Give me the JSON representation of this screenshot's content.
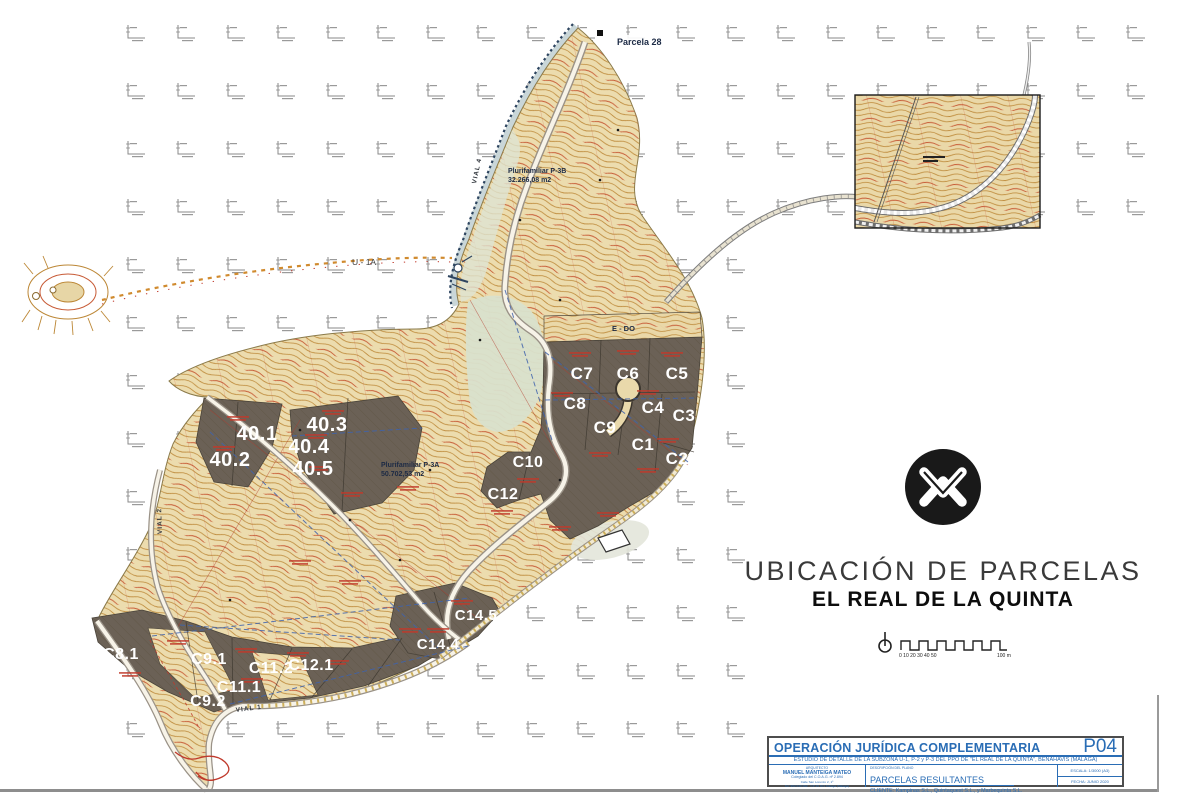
{
  "map": {
    "parcels": [
      {
        "id": "40.1",
        "x": 257,
        "y": 440,
        "s": 20
      },
      {
        "id": "40.2",
        "x": 230,
        "y": 466,
        "s": 20
      },
      {
        "id": "40.3",
        "x": 327,
        "y": 431,
        "s": 20
      },
      {
        "id": "40.4",
        "x": 309,
        "y": 453,
        "s": 20
      },
      {
        "id": "40.5",
        "x": 313,
        "y": 475,
        "s": 20
      },
      {
        "id": "C7",
        "x": 582,
        "y": 379,
        "s": 17
      },
      {
        "id": "C6",
        "x": 628,
        "y": 379,
        "s": 17
      },
      {
        "id": "C5",
        "x": 677,
        "y": 379,
        "s": 17
      },
      {
        "id": "C8",
        "x": 575,
        "y": 409,
        "s": 17
      },
      {
        "id": "C4",
        "x": 653,
        "y": 413,
        "s": 17
      },
      {
        "id": "C3",
        "x": 684,
        "y": 421,
        "s": 17
      },
      {
        "id": "C9",
        "x": 605,
        "y": 433,
        "s": 17
      },
      {
        "id": "C1",
        "x": 643,
        "y": 450,
        "s": 17
      },
      {
        "id": "C2",
        "x": 677,
        "y": 464,
        "s": 17
      },
      {
        "id": "C10",
        "x": 528,
        "y": 467,
        "s": 16
      },
      {
        "id": "C12",
        "x": 503,
        "y": 499,
        "s": 16
      },
      {
        "id": "C14.5",
        "x": 476,
        "y": 620,
        "s": 15
      },
      {
        "id": "C14.4",
        "x": 438,
        "y": 649,
        "s": 15
      },
      {
        "id": "C8.1",
        "x": 121,
        "y": 659,
        "s": 16
      },
      {
        "id": "C9.1",
        "x": 209,
        "y": 664,
        "s": 16
      },
      {
        "id": "C11.2",
        "x": 271,
        "y": 673,
        "s": 16
      },
      {
        "id": "C12.1",
        "x": 311,
        "y": 670,
        "s": 16
      },
      {
        "id": "C11.1",
        "x": 239,
        "y": 692,
        "s": 16
      },
      {
        "id": "C9.2",
        "x": 208,
        "y": 706,
        "s": 16
      }
    ],
    "labels": {
      "parcela28": "Parcela 28",
      "pluri_b1": "Plurifamiliar P-3B",
      "pluri_b2": "32.266,08 m2",
      "pluri_a1": "Plurifamiliar P-3A",
      "pluri_a2": "50.702,53 m2",
      "u1a": "U - 1A",
      "edo": "E - DO",
      "vial4": "VIAL 4",
      "vial2": "VIAL 2",
      "vial1": "VIAL 1"
    }
  },
  "legend": {
    "title": "UBICACIÓN DE PARCELAS",
    "subtitle": "EL REAL DE LA QUINTA",
    "scale_ticks": "0 10 20 30 40 50",
    "scale_end": "100 m"
  },
  "titleblock": {
    "title": "OPERACIÓN JURÍDICA COMPLEMENTARIA",
    "sheet": "P04",
    "project": "ESTUDIO DE DETALLE DE LA SUBZONA U-1, P-2 y P-3 DEL PPO DE \"EL REAL DE LA QUINTA\", BENAHAVÍS (MÁLAGA)",
    "architect_heading": "ARQUITECTO",
    "architect_name": "MANUEL MANTEIGA MATEO",
    "architect_line1": "Colegiado del C.O.A.G. nº 2.894",
    "architect_line2": "Calle San Lorenzo 2, 1º",
    "architect_line3": "Tel: 952 040 092 - CP 29 001 Málaga (Málaga)",
    "desc_heading": "DESCRIPCIÓN DEL PLANO",
    "desc": "PARCELAS RESULTANTES",
    "client": "CLIENTE: Kampinas S.L., Quintaquest S.L., y Marbequinta S.L.",
    "scale": "ESCALA: 1/3000 (A3)",
    "date": "FECHA: JUNIO 2020"
  },
  "colors": {
    "accent_blue": "#2a6db5",
    "contour": "#bc8736",
    "index_contour": "#c75a35",
    "parcel_fill": "#6b6156",
    "red_lines": "#c0392b",
    "utility_blue": "#3f63ad",
    "coast": "#c9d6d8",
    "valley": "#d9e0cc",
    "logo_black": "#191919"
  }
}
